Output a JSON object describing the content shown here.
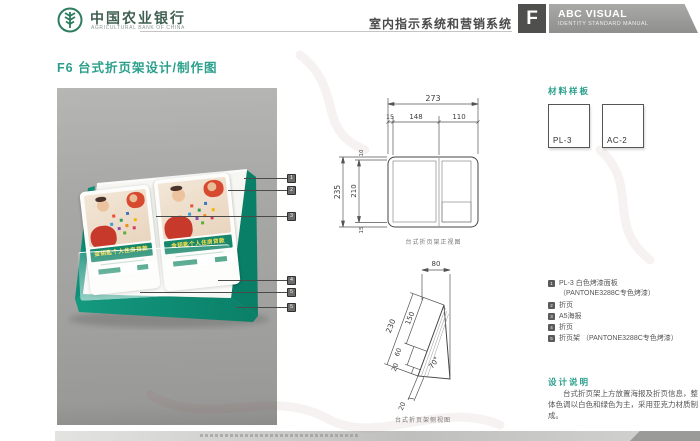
{
  "header": {
    "bank_name": "中国农业银行",
    "bank_name_en": "AGRICULTURAL BANK OF CHINA",
    "section_title": "室内指示系统和营销系统",
    "section_letter": "F",
    "manual_title": "ABC VISUAL",
    "manual_subtitle": "IDENTITY STANDARD MANUAL"
  },
  "page": {
    "title": "F6 台式折页架设计/制作图"
  },
  "photo": {
    "brochure_title": "金钥匙个人住房贷款",
    "callouts": [
      "1",
      "2",
      "3",
      "4",
      "5",
      "5"
    ]
  },
  "materials": {
    "label": "材料样板",
    "samples": [
      {
        "code": "PL-3"
      },
      {
        "code": "AC-2"
      }
    ]
  },
  "drawings": {
    "front_view": {
      "caption": "台式折页架正视图",
      "dims": {
        "total_width": "273",
        "left": "15",
        "panel": "148",
        "right": "110",
        "total_height": "235",
        "inner_height": "210",
        "top": "10",
        "bottom": "15"
      }
    },
    "side_view": {
      "caption": "台式折页架侧视图",
      "dims": {
        "top_width": "80",
        "slant_total": "230",
        "slant_upper": "150",
        "slant_mid": "60",
        "slant_lower": "20",
        "base": "20",
        "angle": "70°"
      }
    }
  },
  "legend": {
    "items": [
      {
        "num": "1",
        "text": "PL-3 白色烤漆面板",
        "text2": "（PANTONE3288C专色烤漆）"
      },
      {
        "num": "2",
        "text": "折页"
      },
      {
        "num": "3",
        "text": "A5海报"
      },
      {
        "num": "4",
        "text": "折页"
      },
      {
        "num": "5",
        "text": "折页架 （PANTONE3288C专色烤漆）"
      }
    ]
  },
  "notes": {
    "label": "设计说明",
    "text": "台式折页架上方放置海报及折页信息，整体色调以白色和绿色为主，采用亚克力材质制成。"
  },
  "colors": {
    "brand_teal": "#2aa08c",
    "stand_green": "#0f8f77",
    "band_green": "#17876b",
    "header_gray": "#9a9a98",
    "f_block_gray": "#4f4f4d"
  }
}
